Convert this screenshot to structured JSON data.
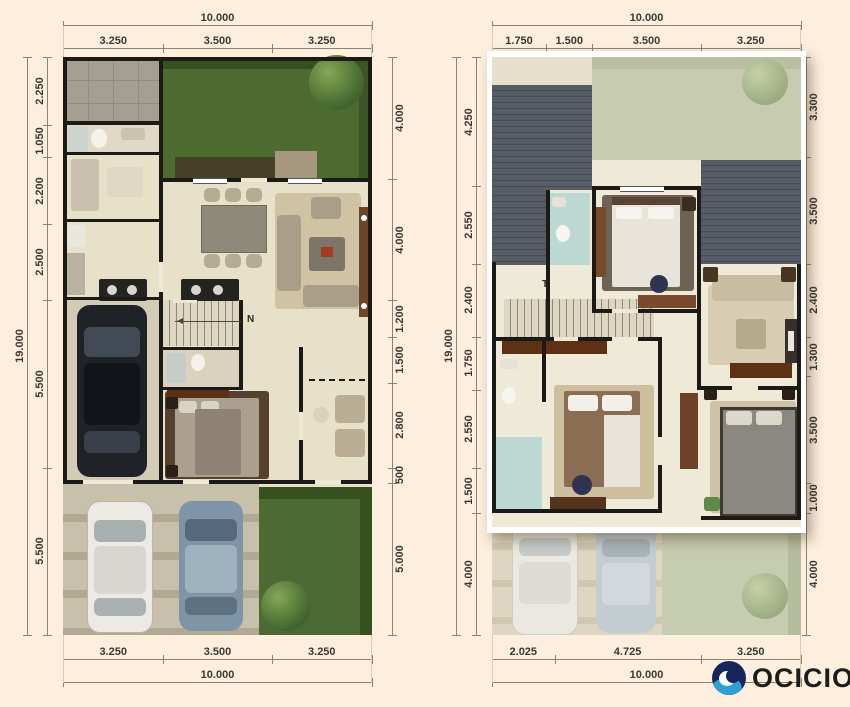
{
  "page": {
    "background": "#fdeedd"
  },
  "logo": {
    "brand": "OCICIO",
    "icon": "swirl-circle-icon",
    "navy": "#16265c",
    "blue": "#2e9ed6",
    "text_color": "#1c1c1a"
  },
  "plans": [
    {
      "id": "ground-floor",
      "top_total": "10.000",
      "top_segments": [
        "3.250",
        "3.500",
        "3.250"
      ],
      "left_total": "19.000",
      "left_segments": [
        "2.250",
        "1.050",
        "2.200",
        "2.500",
        "5.500",
        "5.500"
      ],
      "right_segments": [
        "4.000",
        "4.000",
        "1.200",
        "1.500",
        "2.800",
        "500",
        "5.000"
      ],
      "bottom_segments": [
        "3.250",
        "3.500",
        "3.250"
      ],
      "bottom_total": "10.000",
      "annotations": {
        "north": "N"
      }
    },
    {
      "id": "upper-floor",
      "top_total": "10.000",
      "top_segments": [
        "1.750",
        "1.500",
        "3.500",
        "3.250"
      ],
      "left_total": "19.000",
      "left_segments": [
        "4.250",
        "2.550",
        "2.400",
        "1.750",
        "2.550",
        "1.500",
        "4.000"
      ],
      "right_segments": [
        "3.300",
        "3.500",
        "2.400",
        "1.300",
        "3.500",
        "1.000",
        "4.000"
      ],
      "bottom_segments": [
        "2.025",
        "4.725",
        "3.250"
      ],
      "bottom_total": "10.000",
      "annotations": {
        "stair": "T"
      }
    }
  ]
}
